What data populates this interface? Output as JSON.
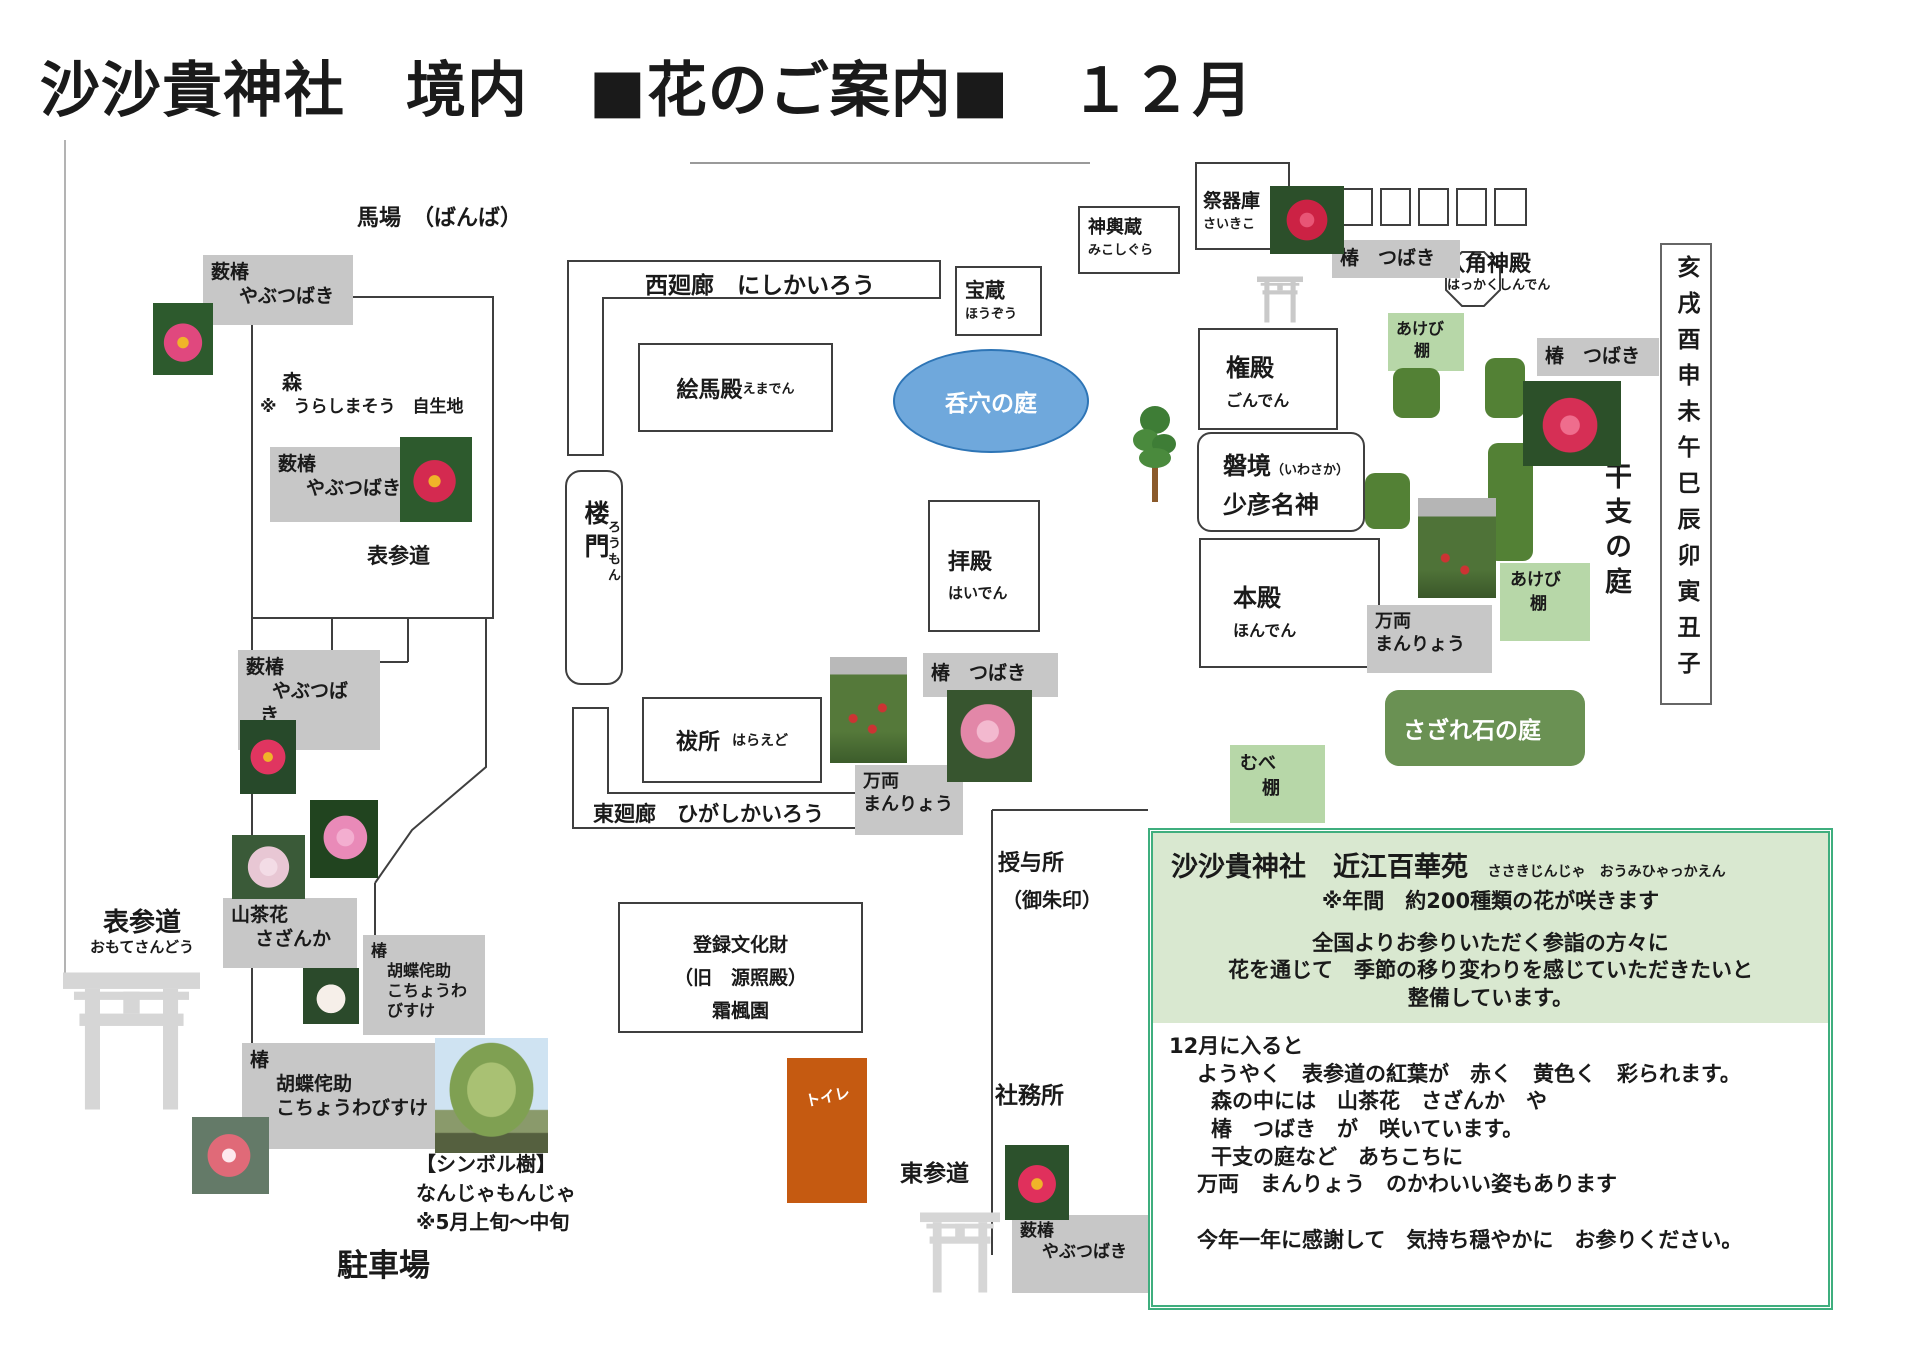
{
  "colors": {
    "gray_label": "#c7c7c7",
    "light_green": "#b7d7a8",
    "dark_green": "#538135",
    "sazare_green": "#6a9153",
    "info_border": "#3fae7e",
    "info_bg": "#d9e8d0",
    "oval_blue": "#6fa8dc",
    "oval_border": "#2e75b6",
    "toilet_orange": "#c55a11",
    "torii_gray": "#d6d6d6"
  },
  "title": "沙沙貴神社　境内　■花のご案内■　１２月",
  "areas": {
    "banba": "馬場　（ばんば）",
    "omotesando_mid": "表参道",
    "omotesando_left": "表参道",
    "omotesando_left_furi": "おもてさんどう",
    "higashisando": "東参道",
    "parking": "駐車場",
    "juyosho_l1": "授与所",
    "juyosho_l2": "（御朱印）",
    "shamusho": "社務所",
    "toilet": "トイレ",
    "eto_garden": "干支の庭",
    "zodiac": "亥戌酉申未午巳辰卯寅丑子",
    "sazare": "さざれ石の庭",
    "oval": "呑穴の庭"
  },
  "buildings": {
    "nishikairo": "西廻廊　にしかいろう",
    "higashikairo": "東廻廊　ひがしかいろう",
    "hozo": {
      "name": "宝蔵",
      "furi": "ほうぞう"
    },
    "mikoshigura": {
      "name": "神輿蔵",
      "furi": "みこしぐら"
    },
    "saikiko": {
      "name": "祭器庫",
      "furi": "さいきこ"
    },
    "hakkaku": {
      "name": "八角神殿",
      "furi": "はっかくしんでん"
    },
    "gonden": {
      "name": "権殿",
      "furi": "ごんでん"
    },
    "iwasaka": {
      "name": "磐境",
      "furi": "（いわさか）",
      "name2": "少彦名神"
    },
    "honden": {
      "name": "本殿",
      "furi": "ほんでん"
    },
    "haiden": {
      "name": "拝殿",
      "furi": "はいでん"
    },
    "emaden": {
      "name": "絵馬殿",
      "furi": "えまでん"
    },
    "romon": {
      "name": "楼門",
      "furi": "ろうもん"
    },
    "haraedo": {
      "name": "祓所",
      "furi": "はらえど"
    },
    "bunkazai": {
      "l1": "登録文化財",
      "l2": "（旧　源照殿）",
      "l3": "霜楓園"
    },
    "mori": {
      "l1": "森",
      "l2": "※　うらしまそう　自生地"
    }
  },
  "flower_labels": {
    "yabu1": {
      "l1": "薮椿",
      "l2": "やぶつばき"
    },
    "yabu2": {
      "l1": "薮椿",
      "l2": "やぶつばき"
    },
    "yabu3": {
      "l1": "薮椿",
      "l2": "やぶつば",
      "l3": "き"
    },
    "yabu4": {
      "l1": "薮椿",
      "l2": "やぶつばき"
    },
    "tsubaki_top": "椿　つばき",
    "tsubaki_right": "椿　つばき",
    "tsubaki_mid": "椿　つばき",
    "sazanka": {
      "l1": "山茶花",
      "l2": "さざんか"
    },
    "kocho1": {
      "l1": "椿",
      "l2": "胡蝶侘助",
      "l3": "こちょうわびすけ"
    },
    "kocho2": {
      "l1": "椿",
      "l2": "胡蝶侘助",
      "l3": "こちょうわびすけ"
    },
    "manryo_mid": {
      "l1": "万両",
      "l2": "まんりょう"
    },
    "manryo_right": {
      "l1": "万両",
      "l2": "まんりょう"
    },
    "akebi1": {
      "l1": "あけび",
      "l2": "棚"
    },
    "akebi2": {
      "l1": "あけび",
      "l2": "棚"
    },
    "mube": {
      "l1": "むべ",
      "l2": "棚"
    }
  },
  "symbol_tree": {
    "l1": "【シンボル樹】",
    "l2": "なんじゃもんじゃ",
    "l3": "※5月上旬～中旬"
  },
  "info_box": {
    "title": "沙沙貴神社　近江百華苑",
    "title_furi": "ささきじんじゃ　おうみひゃっかえん",
    "sub": "※年間　約200種類の花が咲きます",
    "p1": "全国よりお参りいただく参詣の方々に",
    "p2": "花を通じて　季節の移り変わりを感じていただきたいと",
    "p3": "整備しています。",
    "d1": "12月に入ると",
    "d2": "ようやく　表参道の紅葉が　赤く　黄色く　彩られます。",
    "d3": "森の中には　山茶花　さざんか　や",
    "d4": "椿　つばき　が　咲いています。",
    "d5": "干支の庭など　あちこちに",
    "d6": "万両　まんりょう　のかわいい姿もあります",
    "d7": "今年一年に感謝して　気持ち穏やかに　お参りください。"
  }
}
